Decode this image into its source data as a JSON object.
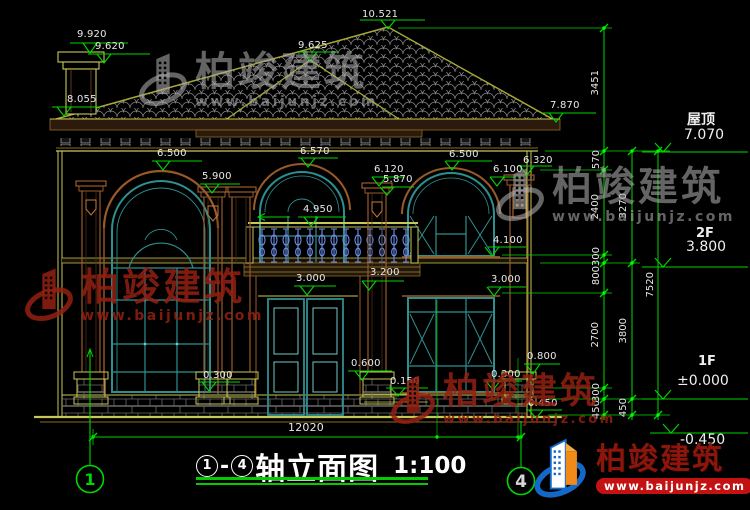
{
  "watermark": {
    "brand": "柏竣建筑",
    "url": "www.baijunjz.com"
  },
  "title": {
    "axis_start": "1",
    "separator": "-",
    "axis_end": "4",
    "text": "轴立面图",
    "scale": "1:100"
  },
  "axis_bubbles": {
    "left": "1",
    "right": "4"
  },
  "levels": {
    "roof_label": "屋顶",
    "roof_value": "7.070",
    "floor2_label": "2F",
    "floor2_value": "3.800",
    "floor1_label": "1F",
    "floor1_value": "±0.000",
    "ground_value": "-0.450"
  },
  "elevations": {
    "ridge": "10.521",
    "chimney_top": "9.920",
    "chimney_cap": "9.620",
    "eave_left": "8.055",
    "bay_apex": "9.625",
    "eave_right": "7.870",
    "window_left_top": "6.500",
    "capital_left": "5.900",
    "window_center_top": "6.570",
    "capital_center_upper": "6.120",
    "capital_center_lower": "5.870",
    "window_right_top": "6.500",
    "window_right_spring": "6.100",
    "capital_right": "6.320",
    "balcony_rail": "4.950",
    "window_right_sill": "4.100",
    "balcony_floor": "3.200",
    "door_head": "3.000",
    "window_right_head": "3.000",
    "pier_right_top": "0.800",
    "pedestal_top": "0.600",
    "sill_left": "0.300",
    "door_side": "0.300",
    "terrace": "0.150",
    "plinth": "0.450"
  },
  "overall_width": "12020",
  "chain_dims": {
    "roof_height": "3451",
    "parapet": "570",
    "floor2_window": "2400",
    "band_upper": "300",
    "spandrel": "800",
    "floor1_window": "2700",
    "band_lower": "300",
    "plinth_a": "450",
    "floor2_total": "3270",
    "floor1_total": "3800",
    "plinth_b": "450",
    "total_height": "7520"
  },
  "colors": {
    "dimension_green": "#00d800",
    "wall_yellow": "#c8c855",
    "trim_brown": "#9a5a28",
    "window_teal": "#2f8f8f",
    "baluster_blue": "#6f8fe8",
    "brand_red": "#8c160c"
  }
}
